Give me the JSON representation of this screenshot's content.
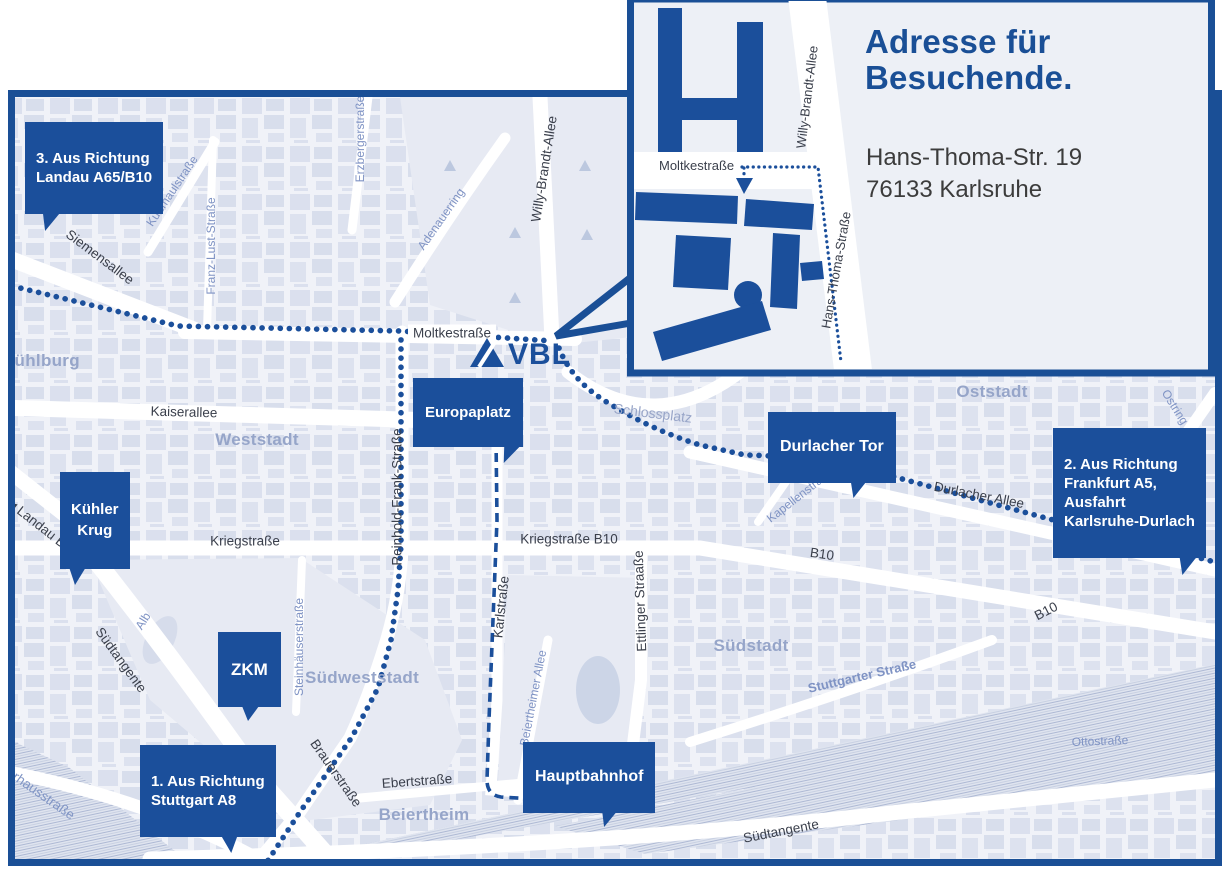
{
  "inset": {
    "title": "Adresse für\nBesuchende.",
    "address": "Hans-Thoma-Str. 19\n76133 Karlsruhe",
    "streets": {
      "moltkestrasse": "Moltkestraße",
      "willy_brandt_allee": "Willy-Brandt-Allee",
      "hans_thoma_strasse": "Hans-Thoma-Straße"
    }
  },
  "logo": {
    "text": "VBL"
  },
  "callouts": {
    "landau": {
      "text": "3. Aus Richtung\nLandau A65/B10"
    },
    "frankfurt": {
      "text": "2. Aus Richtung\nFrankfurt A5,\nAusfahrt\nKarlsruhe-Durlach"
    },
    "stuttgart": {
      "text": "1. Aus Richtung\nStuttgart A8"
    },
    "kuehler_krug": {
      "text": "Kühler\nKrug"
    },
    "zkm": {
      "text": "ZKM"
    },
    "europaplatz": {
      "text": "Europaplatz"
    },
    "durlacher_tor": {
      "text": "Durlacher Tor"
    },
    "hauptbahnhof": {
      "text": "Hauptbahnhof"
    }
  },
  "districts": {
    "muehlburg": "Mühlburg",
    "weststadt": "Weststadt",
    "suedweststadt": "Südweststadt",
    "suedstadt": "Südstadt",
    "oststadt": "Oststadt",
    "beiertheim": "Beiertheim"
  },
  "streets_major": {
    "siemensallee": "Siemensallee",
    "moltkestrasse": "Moltkestraße",
    "kaiserallee": "Kaiserallee",
    "kriegstrasse": "Kriegstraße",
    "kriegstrasse_b10": "Kriegstraße B10",
    "landau_b10": "Landau B10",
    "landau_b10_marker": "◀",
    "karlstrasse": "Karlstraße",
    "reinhold_frank": "Reinhold-Frank-Straße",
    "ettlinger": "Ettlinger Straaße",
    "willy_brandt": "Willy-Brandt-Allee",
    "brauerstrasse": "Brauerstraße",
    "ebertstrasse": "Ebertstraße",
    "suedtangente_west": "Südtangente",
    "suedtangente_sued": "Südtangente",
    "durlacher_allee": "Durlacher Allee",
    "b10_mid": "B10",
    "b10_suedost": "B10",
    "pulverhausstrasse": "Pulverhausstraße"
  },
  "streets_minor": {
    "kussmaulstrasse": "Kußmaulstraße",
    "franz_lust_strasse": "Franz-Lust-Straße",
    "erzbergerstrasse": "Erzbergerstraße",
    "adenauerring": "Adenauerring",
    "schlossplatz": "Schlossplatz",
    "kapellenstrasse": "Kapellenstraße",
    "ostring": "Ostring",
    "steinhaeuserstrasse": "Steinhäuserstraße",
    "beiertheimer_allee": "Beiertheimer Allee",
    "stuttgarter_strasse": "Stuttgarter Straße",
    "ottostrasse": "Ottostraße",
    "alb": "Alb"
  },
  "colors": {
    "brand_blue": "#1b4f9b",
    "frame_blue": "#1a4f96",
    "district_label": "#96a5c9",
    "minor_street_label": "#7f93c4",
    "major_street_label": "#3a3f4b",
    "map_background": "#f0f2f8"
  }
}
